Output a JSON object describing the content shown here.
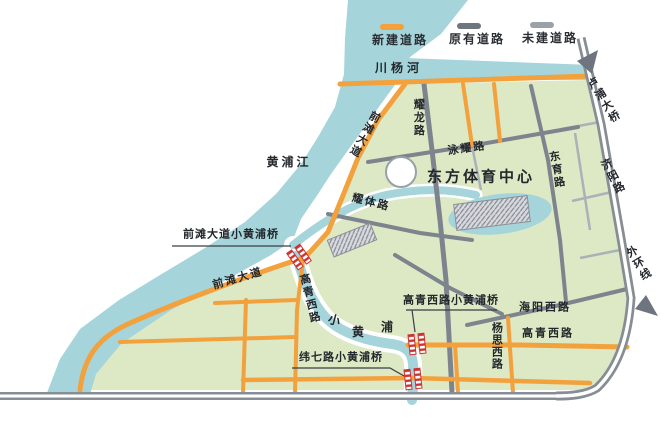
{
  "legend": {
    "items": [
      {
        "id": "new-road",
        "label": "新建道路",
        "color": "#f2a13c"
      },
      {
        "id": "existing-road",
        "label": "原有道路",
        "color": "#6f757e"
      },
      {
        "id": "planned-road",
        "label": "未建道路",
        "color": "#9ba1a8"
      }
    ]
  },
  "map": {
    "waters": {
      "chuanyang_river": "川杨河",
      "huangpu_river": "黄浦江",
      "xiao_huangpu_chars": [
        "小",
        "黄",
        "浦"
      ]
    },
    "roads": {
      "qiantan_ave_upper": "前滩大道",
      "qiantan_ave_lower": "前滩大道",
      "yaolong": "耀龙路",
      "yongyao": "泳耀路",
      "dongyu": "东育路",
      "yaoti": "耀体路",
      "lupu_bridge": "卢浦大桥",
      "jiyang": "济阳路",
      "outer_ring": "外环线",
      "gaoqing_west_ns": "高青西路",
      "gaoqing_west_ew": "高青西路",
      "haiyang_west": "海阳西路",
      "yangsi_west": "杨思西路"
    },
    "bridges": {
      "qiantan_bridge": "前滩大道小黄浦桥",
      "gaoqing_bridge": "高青西路小黄浦桥",
      "weiqi_bridge": "纬七路小黄浦桥"
    },
    "poi": {
      "sports_center": "东方体育中心"
    },
    "colors": {
      "water": "#a5d5da",
      "land": "#dde8c4",
      "new_road": "#f2a13c",
      "existing_road": "#7e848d",
      "planned_road": "#abb1b8",
      "bridge_marker": "#cc3333"
    }
  }
}
